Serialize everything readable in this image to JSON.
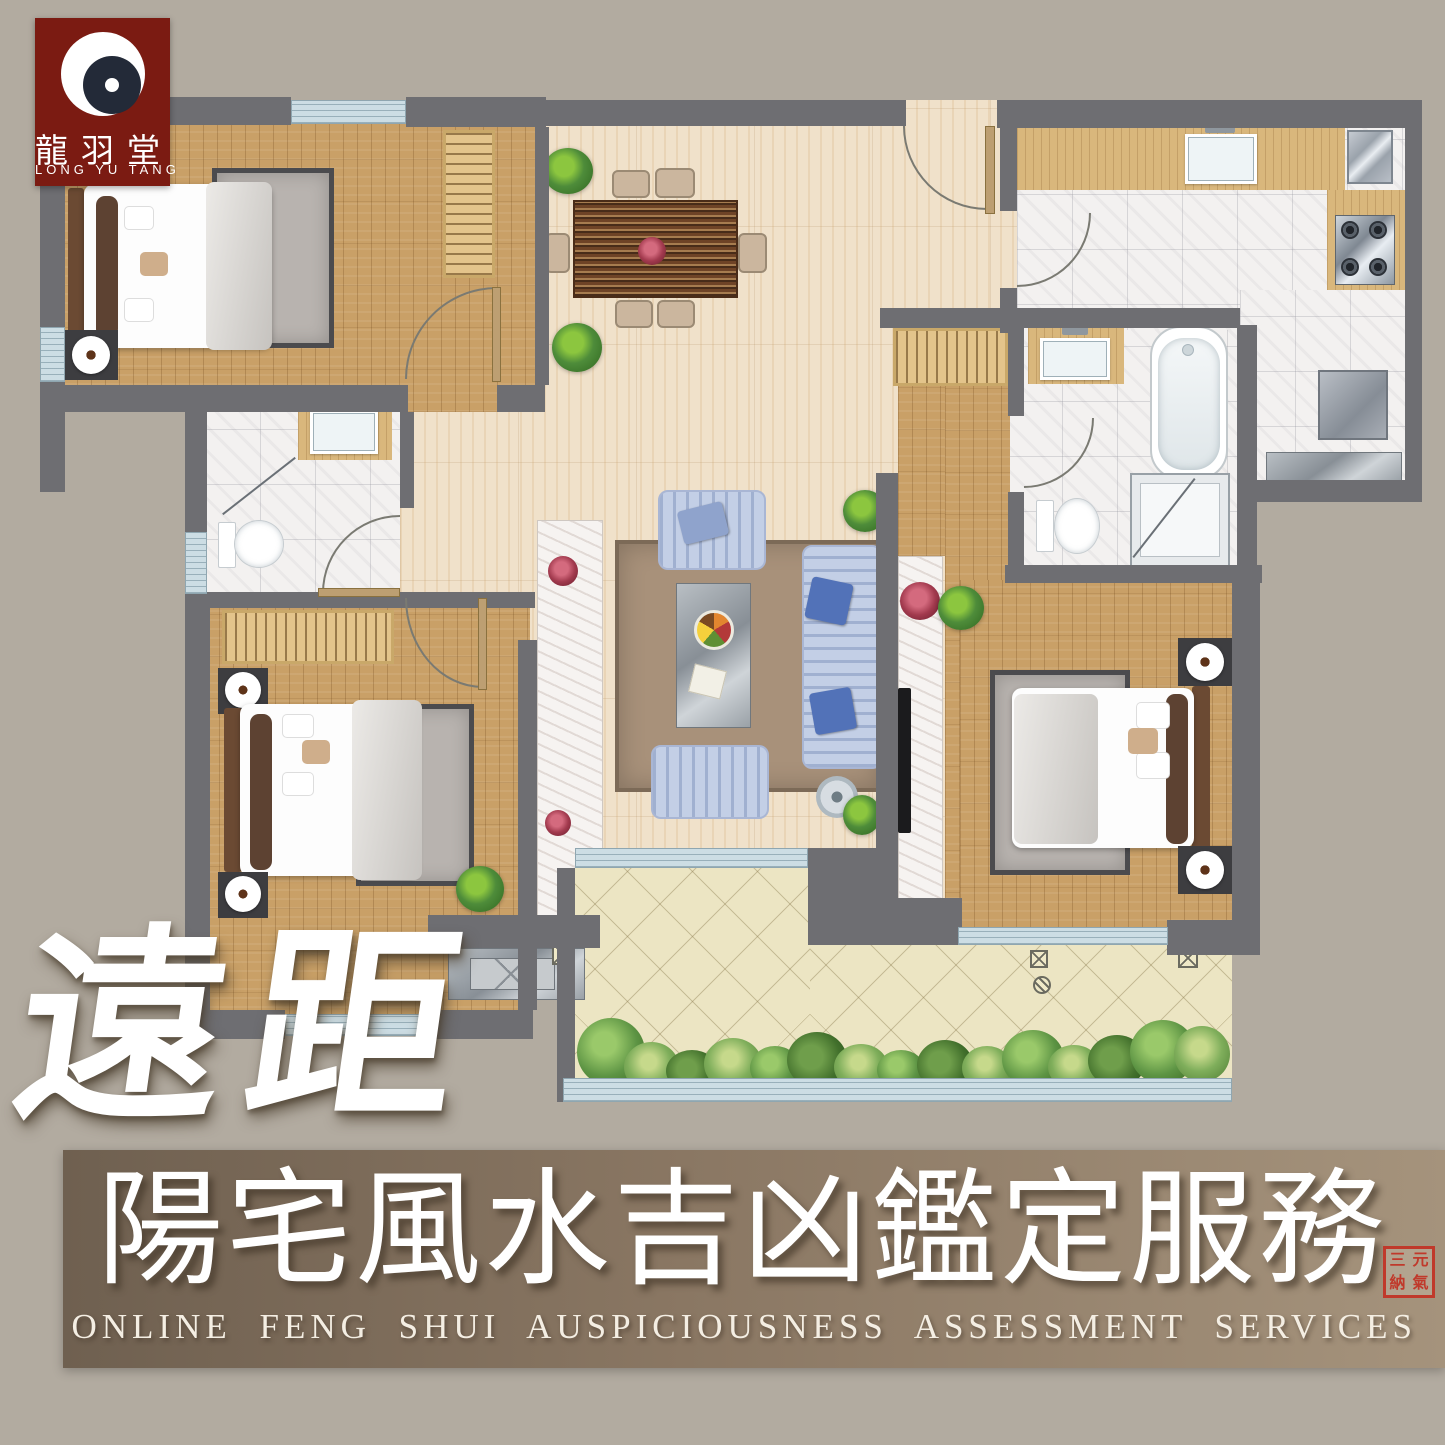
{
  "logo": {
    "icon": "dragon-yinyang-icon",
    "hanzi": "龍羽堂",
    "latin": "LONG YU TANG"
  },
  "watermark": {
    "text": "遠距"
  },
  "banner": {
    "title_zh": "陽宅風水吉凶鑑定服務",
    "subtitle_en": "ONLINE FENG SHUI AUSPICIOUSNESS ASSESSMENT SERVICES",
    "seal_chars": [
      "三",
      "元",
      "納",
      "氣"
    ]
  },
  "palette": {
    "background": "#b2aba0",
    "wall": "#6e6e72",
    "wood": "#c9a067",
    "marble_beige": "#f0e1ca",
    "marble_white": "#f3f1f0",
    "balcony_tile": "#ece5c3",
    "window_blue": "#ccdde4",
    "rug_gray": "#b8b3af",
    "rug_brown": "#a8917a",
    "sofa_blue": "#c3cfe6",
    "cushion_blue": "#5272b8",
    "counter_wood": "#d9b77c",
    "plant_green": "#4e8c3a",
    "flower_red": "#a23a4e",
    "logo_red": "#7b1b12",
    "banner_left": "#6f6050",
    "banner_right": "#a5937c",
    "seal_red": "#c0392b"
  }
}
